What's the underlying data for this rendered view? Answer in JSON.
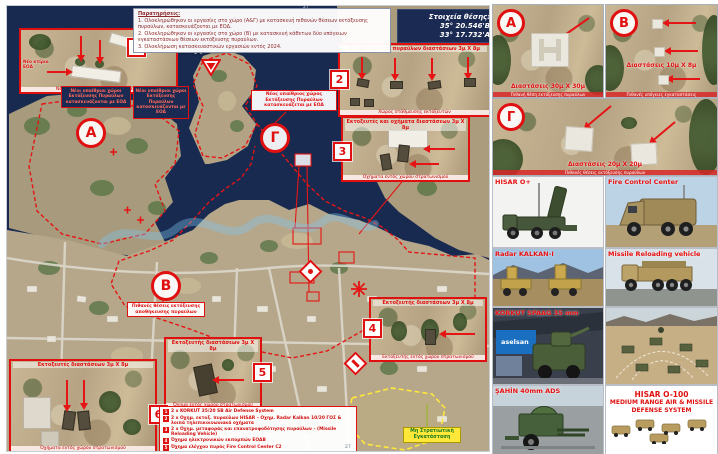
{
  "map": {
    "observations": {
      "title": "Παρατηρήσεις:",
      "l1": "1. Ολοκληρώθηκαν οι εργασίες στο χώρο (Α&Γ) με κατασκευή πιθανών θέσεων εκτόξευσης πυραύλων, κατασκευάζονται με ΕΟΔ.",
      "l2": "2. Ολοκληρώθηκαν οι εργασίες στο χώρο (Β) με κατασκευή κάθετων δύο υπόγειων εγκαταστάσεων θέσεων εκτόξευσης πυραύλων.",
      "l3": "3. Ολοκλήρωση κατασκευαστικών εργασιών εντός 2024."
    },
    "position_box": {
      "label": "Στοιχεία θέσης:",
      "lat": "35° 20.546'Β",
      "lon": "33° 17.732'Α"
    },
    "graticule": {
      "top": "27",
      "bottom": "27"
    },
    "place_label": "Milli Agay Rambarı",
    "areas": {
      "a": "Α",
      "b": "Β",
      "g": "Γ"
    },
    "tags": {
      "t1": "1",
      "t2": "2",
      "t3": "3",
      "t4": "4",
      "t5": "5",
      "t6": "6"
    },
    "notes": {
      "open_site_1": "Νέοι υπαίθριοι χώροι Εκτόξευσης Πυραύλων κατασκευάζονται με ΕΟΔ",
      "open_site_2": "Νέοι υπαίθριοι χώροι Εκτόξευσης Πυραύλων κατασκευάζονται με ΕΟΔ",
      "open_site_g": "Νέος υπαίθριος χώρος Εκτόξευσης Πυραύλων κατασκευάζεται με ΕΟΔ",
      "b_note": "Πιθανές θέσεις εκτόξευσης αποθήκευσης πυραύλων",
      "civil": "Μη Στρατιωτική Εγκατάσταση"
    },
    "insets": {
      "i1": {
        "label": "Νέο κτίριο ΕΟΔ",
        "caption": "Νέες κατασκευές εντός στρατοπέδου"
      },
      "i2": {
        "title": "4 x Εκτοξευτές πυραύλων διαστάσεων 3μ Χ 8μ",
        "caption": "Χώρος στάθμευσης εκτοξευτών"
      },
      "i3": {
        "title": "Εκτοξευτές και οχήματα διαστάσεων 3μ Χ 8μ",
        "caption": "Οχήματα εντός χώρου στρατωνισμού"
      },
      "i4": {
        "title": "Εκτοξευτής διαστάσεων 3μ Χ 8μ",
        "caption": "Εκτοξευτής εντός χώρου στρατωνισμού"
      },
      "i5": {
        "title": "Εκτοξευτής διαστάσεων 3μ Χ 8μ",
        "caption": "Όχημα εντός χώρου στρατωνισμού"
      },
      "i6": {
        "title": "Εκτοξευτές διαστάσεων 3μ Χ 8μ",
        "caption": "Οχήματα εντός χώρου στρατωνισμού"
      }
    },
    "legend": {
      "items": [
        {
          "n": "1",
          "t": "2 x KORKUT 35/20 SB Air Defense System"
        },
        {
          "n": "2",
          "t": "2 x Οχημ. εκτοξ. πυραύλων HISAR – Οχημ. Radar Kalkan 10/20 ΓΟΣ & λοιπά τηλεπικοινωνιακά οχήματα"
        },
        {
          "n": "3",
          "t": "2 x Οχημ. μεταφοράς και επανατροφοδότησης πυραύλων – (Missile Reloading Vehicle)"
        },
        {
          "n": "4",
          "t": "Όχημα ηλεκτρονικών εκπομπών ΕΟΔΒ"
        },
        {
          "n": "5",
          "t": "Όχημα ελέγχου πυρός Fire Control Center C2"
        },
        {
          "n": "6",
          "t": "2 x Όχημα ραντάρ πυραύλων Radar Kalkan - X"
        }
      ]
    }
  },
  "right": {
    "sat_tiles": [
      {
        "letter": "Α",
        "dimension": "Διαστάσεις 30μ Χ 30μ",
        "caption": "Πιθανή θέση εκτόξευσης πυραύλων"
      },
      {
        "letter": "Β",
        "dimension": "Διαστάσεις 10μ Χ 8μ",
        "caption": "Πιθανές υπόγειες εγκαταστάσεις"
      },
      {
        "letter": "Γ",
        "dimension": "Διαστάσεις 20μ Χ 20μ",
        "caption": "Πιθανές θέσεις εκτόξευσης πυραύλων"
      }
    ],
    "equipment": [
      {
        "label": "HISAR O+"
      },
      {
        "label": "Fire Control Center"
      },
      {
        "label": "Radar KALKAN-I"
      },
      {
        "label": "Missile Reloading vehicle"
      },
      {
        "label": "KORKUT SPAAG 35 mm"
      },
      {
        "label": "ŞAHİN 40mm ADS"
      }
    ],
    "aselsan_sign": "aselsan",
    "system_panel": {
      "title": "HISAR O-100",
      "subtitle": "MEDIUM RANGE AIR & MISSILE DEFENSE SYSTEM"
    }
  },
  "colors": {
    "annotation_red": "#e01010",
    "navy": "#1b2a52",
    "yellow": "#ffe83a"
  }
}
